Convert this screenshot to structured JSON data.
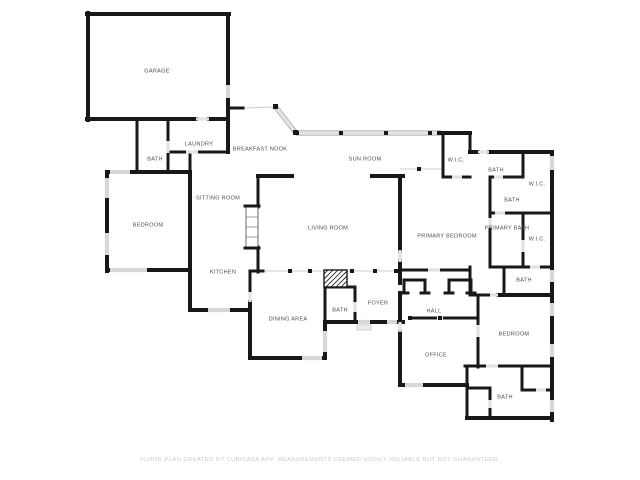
{
  "page": {
    "background": "#ffffff",
    "footer": "FLOOR PLAN CREATED BY CUBICASA APP. MEASUREMENTS DEEMED HIGHLY RELIABLE BUT NOT GUARANTEED."
  },
  "floor_plan": {
    "colors": {
      "wall": "#181818",
      "door": "#e2e2e2",
      "window": "#d7d7d7",
      "thin": "#cccccc",
      "band_fill": "#e3e3e3",
      "band_edge": "#9a9a9a",
      "label": "#4f4f4f"
    },
    "rooms": [
      {
        "name": "garage",
        "label": "GARAGE",
        "x": 157,
        "y": 71
      },
      {
        "name": "laundry",
        "label": "LAUNDRY",
        "x": 199,
        "y": 144
      },
      {
        "name": "bath-1",
        "label": "BATH",
        "x": 155,
        "y": 159
      },
      {
        "name": "breakfast-nook",
        "label": "BREAKFAST NOOK",
        "x": 260,
        "y": 149
      },
      {
        "name": "sun-room",
        "label": "SUN ROOM",
        "x": 365,
        "y": 159
      },
      {
        "name": "wic-1",
        "label": "W.I.C.",
        "x": 456,
        "y": 160
      },
      {
        "name": "bath-2",
        "label": "BATH",
        "x": 496,
        "y": 170
      },
      {
        "name": "wic-2",
        "label": "W.I.C.",
        "x": 537,
        "y": 184
      },
      {
        "name": "bath-3",
        "label": "BATH",
        "x": 512,
        "y": 200
      },
      {
        "name": "sitting-room",
        "label": "SITTING ROOM",
        "x": 218,
        "y": 198
      },
      {
        "name": "bedroom-1",
        "label": "BEDROOM",
        "x": 148,
        "y": 225
      },
      {
        "name": "living-room",
        "label": "LIVING ROOM",
        "x": 328,
        "y": 228
      },
      {
        "name": "primary-bedroom",
        "label": "PRIMARY BEDROOM",
        "x": 447,
        "y": 236
      },
      {
        "name": "primary-bath",
        "label": "PRIMARY BATH",
        "x": 507,
        "y": 228
      },
      {
        "name": "wic-3",
        "label": "W.I.C.",
        "x": 537,
        "y": 239
      },
      {
        "name": "kitchen",
        "label": "KITCHEN",
        "x": 223,
        "y": 272
      },
      {
        "name": "bath-4",
        "label": "BATH",
        "x": 524,
        "y": 280
      },
      {
        "name": "foyer",
        "label": "FOYER",
        "x": 378,
        "y": 303
      },
      {
        "name": "bath-5",
        "label": "BATH",
        "x": 340,
        "y": 310
      },
      {
        "name": "hall",
        "label": "HALL",
        "x": 434,
        "y": 311
      },
      {
        "name": "dining-area",
        "label": "DINING AREA",
        "x": 288,
        "y": 319
      },
      {
        "name": "bedroom-2",
        "label": "BEDROOM",
        "x": 514,
        "y": 334
      },
      {
        "name": "office",
        "label": "OFFICE",
        "x": 436,
        "y": 355
      },
      {
        "name": "bath-6",
        "label": "BATH",
        "x": 505,
        "y": 397
      }
    ],
    "walls": [
      [
        87,
        14,
        229,
        14,
        4
      ],
      [
        88,
        13,
        88,
        120,
        4
      ],
      [
        87,
        119,
        196,
        119,
        4
      ],
      [
        209,
        119,
        228,
        119,
        4
      ],
      [
        228,
        14,
        228,
        85,
        4
      ],
      [
        228,
        98,
        228,
        120,
        4
      ],
      [
        228,
        108,
        243,
        108,
        3
      ],
      [
        137,
        119,
        137,
        172,
        3
      ],
      [
        168,
        119,
        168,
        141,
        3
      ],
      [
        168,
        153,
        168,
        172,
        3
      ],
      [
        168,
        152,
        186,
        152,
        3
      ],
      [
        198,
        152,
        228,
        152,
        3
      ],
      [
        228,
        119,
        228,
        152,
        4
      ],
      [
        190,
        152,
        190,
        172,
        3
      ],
      [
        107,
        172,
        190,
        172,
        4
      ],
      [
        107,
        172,
        107,
        271,
        4
      ],
      [
        107,
        270,
        190,
        270,
        4
      ],
      [
        190,
        172,
        190,
        310,
        4
      ],
      [
        190,
        310,
        250,
        310,
        4
      ],
      [
        250,
        271,
        250,
        292,
        3
      ],
      [
        250,
        302,
        250,
        358,
        4
      ],
      [
        250,
        358,
        325,
        358,
        4
      ],
      [
        325,
        352,
        325,
        358,
        4
      ],
      [
        325,
        322,
        325,
        331,
        4
      ],
      [
        250,
        271,
        263,
        271,
        3
      ],
      [
        258,
        176,
        292,
        176,
        4
      ],
      [
        372,
        176,
        403,
        176,
        4
      ],
      [
        258,
        176,
        258,
        207,
        3
      ],
      [
        258,
        247,
        258,
        272,
        3
      ],
      [
        325,
        287,
        325,
        322,
        3
      ],
      [
        325,
        287,
        355,
        287,
        3
      ],
      [
        355,
        287,
        355,
        302,
        3
      ],
      [
        355,
        312,
        355,
        322,
        3
      ],
      [
        325,
        322,
        358,
        322,
        4
      ],
      [
        370,
        322,
        387,
        322,
        4
      ],
      [
        397,
        322,
        403,
        322,
        4
      ],
      [
        443,
        133,
        443,
        177,
        3
      ],
      [
        443,
        133,
        470,
        133,
        4
      ],
      [
        470,
        133,
        470,
        152,
        3
      ],
      [
        443,
        177,
        452,
        177,
        3
      ],
      [
        462,
        177,
        470,
        177,
        3
      ],
      [
        470,
        152,
        478,
        152,
        4
      ],
      [
        489,
        152,
        552,
        152,
        4
      ],
      [
        523,
        152,
        523,
        177,
        3
      ],
      [
        503,
        177,
        523,
        177,
        3
      ],
      [
        490,
        177,
        494,
        177,
        3
      ],
      [
        490,
        177,
        490,
        218,
        3
      ],
      [
        490,
        228,
        490,
        267,
        3
      ],
      [
        505,
        213,
        552,
        213,
        3
      ],
      [
        490,
        213,
        495,
        213,
        3
      ],
      [
        523,
        213,
        523,
        240,
        3
      ],
      [
        523,
        252,
        523,
        267,
        3
      ],
      [
        490,
        267,
        530,
        267,
        3
      ],
      [
        540,
        267,
        552,
        267,
        3
      ],
      [
        504,
        267,
        504,
        293,
        3
      ],
      [
        470,
        267,
        470,
        295,
        3
      ],
      [
        470,
        295,
        490,
        295,
        3
      ],
      [
        498,
        295,
        552,
        295,
        4
      ],
      [
        552,
        152,
        552,
        420,
        4
      ],
      [
        400,
        270,
        428,
        270,
        3
      ],
      [
        440,
        270,
        470,
        270,
        3
      ],
      [
        404,
        280,
        404,
        293,
        3
      ],
      [
        425,
        280,
        425,
        293,
        3
      ],
      [
        404,
        280,
        425,
        280,
        3
      ],
      [
        400,
        293,
        408,
        293,
        3
      ],
      [
        421,
        293,
        429,
        293,
        3
      ],
      [
        449,
        280,
        449,
        293,
        3
      ],
      [
        471,
        280,
        471,
        293,
        3
      ],
      [
        449,
        280,
        471,
        280,
        3
      ],
      [
        445,
        293,
        453,
        293,
        3
      ],
      [
        467,
        293,
        475,
        293,
        3
      ],
      [
        400,
        176,
        400,
        250,
        4
      ],
      [
        400,
        262,
        400,
        283,
        4
      ],
      [
        400,
        293,
        400,
        322,
        4
      ],
      [
        400,
        332,
        400,
        385,
        4
      ],
      [
        413,
        318,
        437,
        318,
        3
      ],
      [
        443,
        318,
        478,
        318,
        3
      ],
      [
        478,
        295,
        478,
        325,
        3
      ],
      [
        478,
        337,
        478,
        367,
        3
      ],
      [
        400,
        385,
        467,
        385,
        4
      ],
      [
        465,
        366,
        486,
        366,
        3
      ],
      [
        498,
        366,
        552,
        366,
        3
      ],
      [
        467,
        366,
        467,
        418,
        3
      ],
      [
        455,
        385,
        467,
        385,
        3
      ],
      [
        467,
        388,
        490,
        388,
        3
      ],
      [
        490,
        388,
        490,
        400,
        3
      ],
      [
        490,
        408,
        490,
        418,
        3
      ],
      [
        467,
        418,
        552,
        418,
        4
      ],
      [
        522,
        366,
        522,
        390,
        3
      ],
      [
        522,
        390,
        536,
        390,
        3
      ],
      [
        546,
        390,
        552,
        390,
        3
      ]
    ],
    "doors": [
      [
        196,
        119,
        209,
        119
      ],
      [
        186,
        152,
        198,
        152
      ],
      [
        168,
        141,
        168,
        153
      ],
      [
        250,
        292,
        250,
        302
      ],
      [
        355,
        302,
        355,
        312
      ],
      [
        452,
        177,
        462,
        177
      ],
      [
        478,
        152,
        489,
        152
      ],
      [
        494,
        177,
        503,
        177
      ],
      [
        495,
        213,
        505,
        213
      ],
      [
        523,
        240,
        523,
        252
      ],
      [
        530,
        267,
        540,
        267
      ],
      [
        490,
        295,
        498,
        295
      ],
      [
        428,
        270,
        440,
        270
      ],
      [
        400,
        250,
        400,
        262
      ],
      [
        400,
        322,
        400,
        332
      ],
      [
        437,
        318,
        443,
        318
      ],
      [
        478,
        325,
        478,
        337
      ],
      [
        486,
        366,
        498,
        366
      ],
      [
        490,
        400,
        490,
        408
      ],
      [
        536,
        390,
        546,
        390
      ],
      [
        490,
        218,
        490,
        228
      ]
    ],
    "windows": [
      [
        110,
        172,
        130,
        172
      ],
      [
        107,
        178,
        107,
        198
      ],
      [
        107,
        233,
        107,
        255
      ],
      [
        110,
        270,
        147,
        270
      ],
      [
        208,
        310,
        230,
        310
      ],
      [
        302,
        358,
        322,
        358
      ],
      [
        325,
        331,
        325,
        352
      ],
      [
        405,
        385,
        423,
        385
      ],
      [
        552,
        156,
        552,
        170
      ],
      [
        552,
        270,
        552,
        282
      ],
      [
        552,
        303,
        552,
        316
      ],
      [
        552,
        344,
        552,
        357
      ],
      [
        552,
        400,
        552,
        412
      ],
      [
        228,
        85,
        228,
        98
      ],
      [
        358,
        322,
        370,
        322
      ],
      [
        387,
        322,
        397,
        322
      ]
    ],
    "thin_lines": [
      [
        243,
        108,
        275,
        107
      ],
      [
        262,
        271,
        325,
        271
      ],
      [
        347,
        271,
        400,
        271
      ],
      [
        400,
        169,
        443,
        169
      ]
    ],
    "band": {
      "x1": 296,
      "y1": 133,
      "x2": 441,
      "y2": 133
    },
    "diagonal": {
      "x1": 275,
      "y1": 106,
      "x2": 296,
      "y2": 133,
      "caps": [
        [
          273,
          104
        ],
        [
          293,
          130
        ]
      ]
    },
    "band_edges": [
      [
        296,
        130.8,
        441,
        130.8
      ],
      [
        296,
        135.2,
        441,
        135.2
      ],
      [
        276.7,
        104.7,
        297.7,
        131.7
      ],
      [
        273.3,
        107.3,
        294.3,
        134.3
      ]
    ],
    "posts": [
      [
        297,
        133
      ],
      [
        341,
        133
      ],
      [
        386,
        133
      ],
      [
        430,
        133
      ],
      [
        439,
        133
      ],
      [
        290,
        271
      ],
      [
        310,
        271
      ],
      [
        352,
        271
      ],
      [
        375,
        271
      ],
      [
        396,
        271
      ],
      [
        419,
        169
      ],
      [
        410,
        318
      ],
      [
        440,
        318
      ]
    ],
    "fireplace": {
      "x": 324,
      "y": 270,
      "w": 23,
      "h": 17
    },
    "closet": {
      "x": 246,
      "y": 206,
      "w": 12,
      "h": 42,
      "shelves": [
        217,
        227,
        237
      ]
    },
    "step": {
      "x": 357,
      "y": 325,
      "w": 14,
      "h": 5
    }
  }
}
